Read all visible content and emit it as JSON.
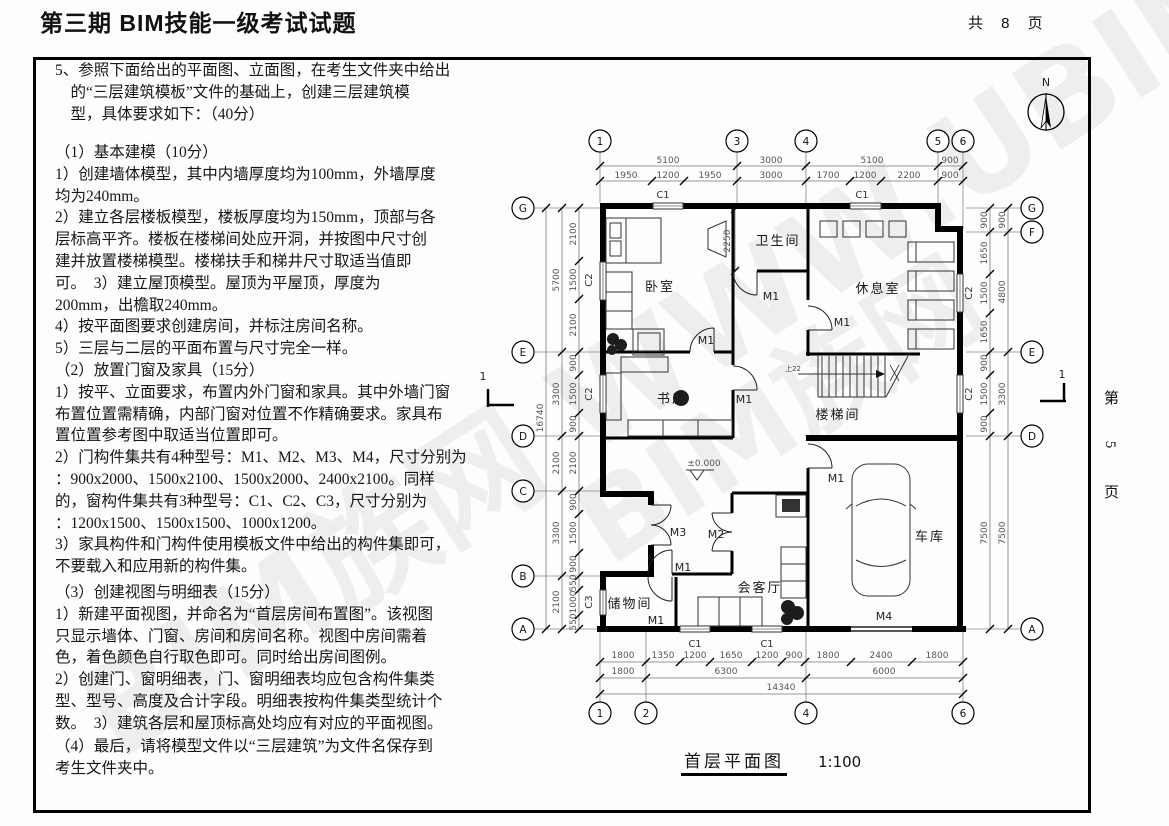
{
  "header": {
    "title": "第三期 BIM技能一级考试试题",
    "pages_total": "共 8 页"
  },
  "side": {
    "page_label": "第 5 页"
  },
  "watermark": {
    "text1": "BIM族网 WWW.UBIM.COM",
    "text2": "BIM族网"
  },
  "question": {
    "intro": "5、参照下面给出的平面图、立面图，在考生文件夹中给出\n　的“三层建筑模板”文件的基础上，创建三层建筑模\n　型，具体要求如下：（40分）",
    "s1": "（1）基本建模（10分）\n1）创建墙体模型，其中内墙厚度均为100mm，外墙厚度\n均为240mm。\n2）建立各层楼板模型，楼板厚度均为150mm，顶部与各\n层标高平齐。楼板在楼梯间处应开洞，并按图中尺寸创\n建并放置楼梯模型。楼梯扶手和梯井尺寸取适当值即\n可。　3）建立屋顶模型。屋顶为平屋顶，厚度为\n200mm，出檐取240mm。\n4）按平面图要求创建房间，并标注房间名称。\n5）三层与二层的平面布置与尺寸完全一样。",
    "s2": "（2）放置门窗及家具（15分）\n1）按平、立面要求，布置内外门窗和家具。其中外墙门窗\n布置位置需精确，内部门窗对位置不作精确要求。家具布\n置位置参考图中取适当位置即可。\n2）门构件集共有4种型号：M1、M2、M3、M4，尺寸分别为\n：900x2000、1500x2100、1500x2000、2400x2100。同样\n的，窗构件集共有3种型号：C1、C2、C3，尺寸分别为\n：1200x1500、1500x1500、1000x1200。\n3）家具构件和门构件使用模板文件中给出的构件集即可，\n不要载入和应用新的构件集。",
    "s3": "（3）创建视图与明细表（15分）\n1）新建平面视图，并命名为“首层房间布置图”。该视图\n只显示墙体、门窗、房间和房间名称。视图中房间需着\n色，着色颜色自行取色即可。同时给出房间图例。\n2）创建门、窗明细表，门、窗明细表均应包含构件集类\n型、型号、高度及合计字段。明细表按构件集类型统计个\n数。　3）建筑各层和屋顶标高处均应有对应的平面视图。",
    "s4": "（4）最后，请将模型文件以“三层建筑”为文件名保存到\n考生文件夹中。"
  },
  "plan": {
    "title": "首层平面图",
    "scale": "1:100",
    "north": "N",
    "section_mark": "1",
    "elevation": "±0.000",
    "stair_note": "上22",
    "bath_dim": "2250",
    "grid": {
      "top": [
        "1",
        "3",
        "4",
        "5",
        "6"
      ],
      "bottom": [
        "1",
        "2",
        "4",
        "6"
      ],
      "left": [
        "G",
        "E",
        "D",
        "C",
        "B",
        "A"
      ],
      "right": [
        "G",
        "F",
        "E",
        "D",
        "A"
      ]
    },
    "rooms": {
      "bedroom": "卧室",
      "bath": "卫生间",
      "lounge": "休息室",
      "study": "书房",
      "stair": "楼梯间",
      "storage": "储物间",
      "living": "会客厅",
      "garage": "车库"
    },
    "doors": {
      "m1": "M1",
      "m2": "M2",
      "m3": "M3",
      "m4": "M4"
    },
    "windows": {
      "c1": "C1",
      "c2": "C2",
      "c3": "C3"
    },
    "dims": {
      "top1": [
        "5100",
        "3000",
        "5100",
        "900"
      ],
      "top2": [
        "1950",
        "1200",
        "1950",
        "3000",
        "1700",
        "1200",
        "2200",
        "900"
      ],
      "bottom1": [
        "1800",
        "1350",
        "1200",
        "1650",
        "1200",
        "900",
        "1800",
        "2400",
        "1800"
      ],
      "bottom2": [
        "1800",
        "6300",
        "6000"
      ],
      "bottom3": "14340",
      "left_total": "16740",
      "left_outer": [
        "5700",
        "3300",
        "2100",
        "3300",
        "2100"
      ],
      "left_inner": [
        "2100",
        "1500",
        "2100",
        "900",
        "1500",
        "900",
        "2100",
        "900",
        "1500",
        "900",
        "550",
        "1000",
        "550"
      ],
      "right_outer": [
        "900",
        "4800",
        "3300",
        "7500"
      ],
      "right_inner": [
        "900",
        "1650",
        "1500",
        "1650",
        "900",
        "1500",
        "900",
        "7500"
      ]
    }
  }
}
